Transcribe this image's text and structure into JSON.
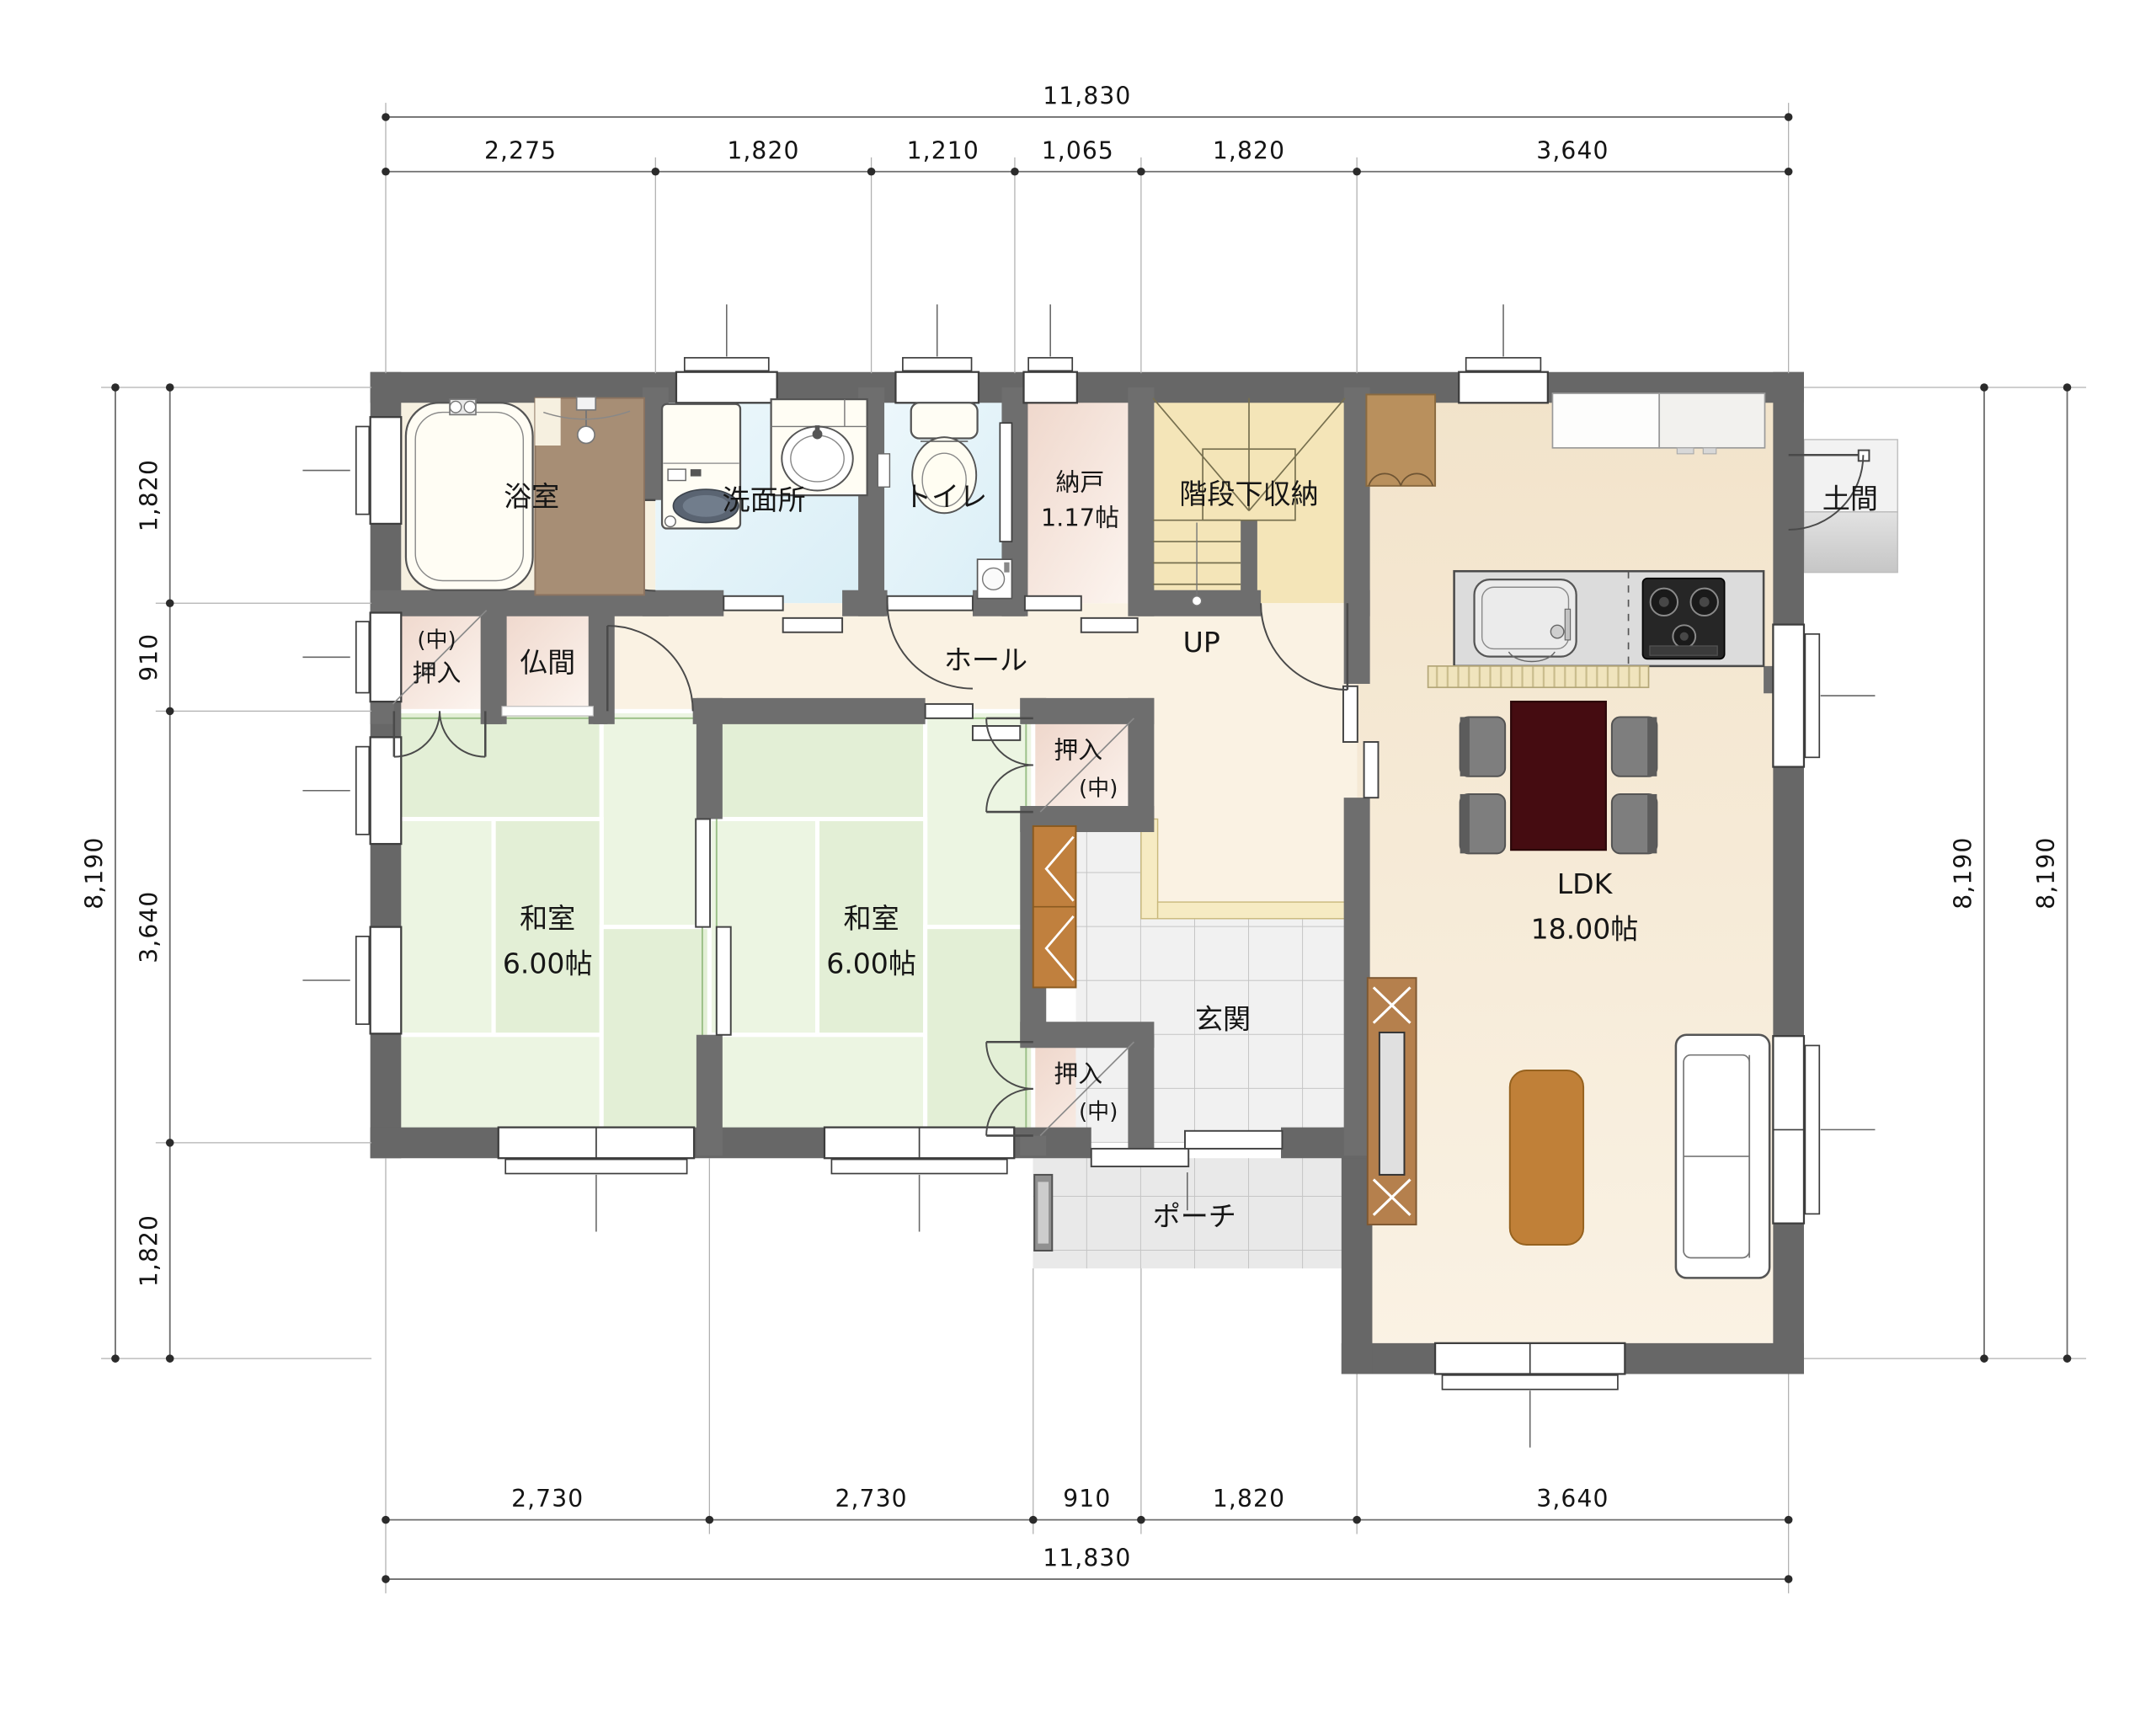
{
  "dims": {
    "top": {
      "total": "11,830",
      "segs": [
        "2,275",
        "1,820",
        "1,210",
        "1,065",
        "1,820",
        "3,640"
      ]
    },
    "bottom": {
      "total": "11,830",
      "segs": [
        "2,730",
        "2,730",
        "910",
        "1,820",
        "3,640"
      ]
    },
    "left": {
      "total": "8,190",
      "segs": [
        "1,820",
        "910",
        "3,640",
        "1,820"
      ]
    },
    "right": {
      "outer": "8,190",
      "inner": "8,190"
    }
  },
  "rooms": {
    "bath": "浴室",
    "washroom": "洗面所",
    "toilet": "トイレ",
    "storage": "納戸",
    "storage_size": "1.17帖",
    "stairs_storage": "階段下収納",
    "up": "UP",
    "doma": "土間",
    "ldk": "LDK",
    "ldk_size": "18.00帖",
    "hall": "ホール",
    "butsuma": "仏間",
    "closet_naka_line1": "(中)",
    "closet_naka_line2": "押入",
    "washitsu": "和室",
    "washitsu_size": "6.00帖",
    "oshiire_line1": "押入",
    "oshiire_line2": "(中)",
    "genkan": "玄関",
    "porch": "ポーチ"
  },
  "colors": {
    "wall": "#6a6a6a",
    "tatami": "#e9f3de",
    "dining_table": "#450c11",
    "wood_furniture": "#c08038",
    "stairs_floor": "#f4e5b8",
    "closet_pink": "#efd8cc",
    "wet_area_blue": "#e3f4fa"
  }
}
